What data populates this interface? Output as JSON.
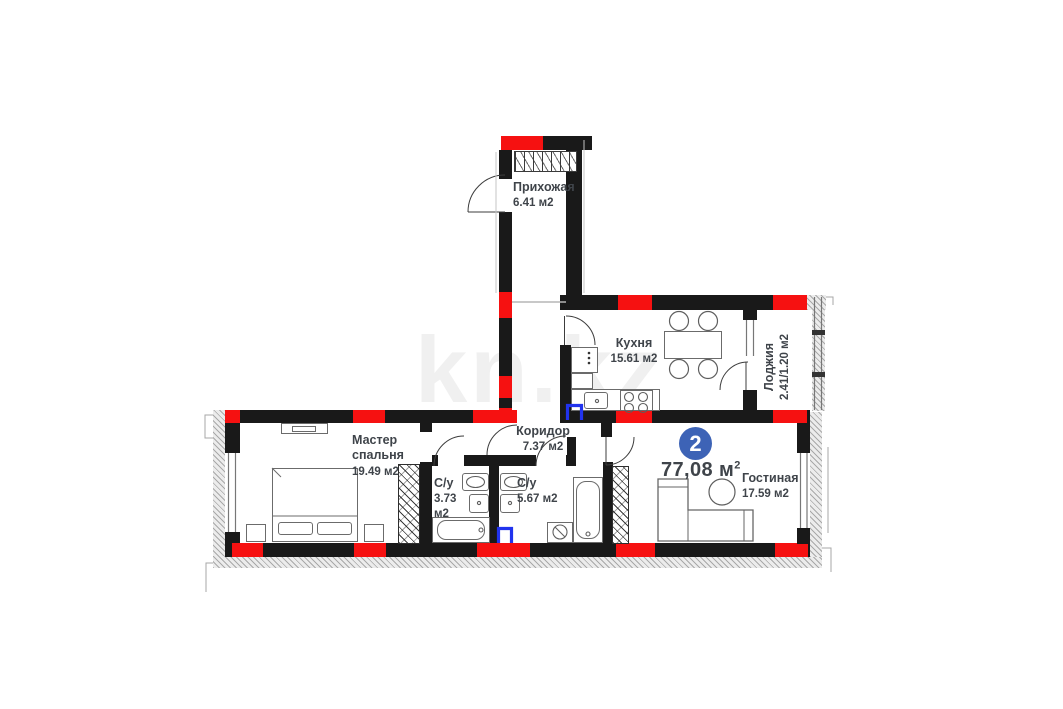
{
  "plan": {
    "watermark": "kn.kz",
    "badge": {
      "number": "2"
    },
    "total_area": {
      "main": "77,08 м",
      "sup": "2"
    },
    "rooms": [
      {
        "name": "Прихожая",
        "area": "6.41 м2"
      },
      {
        "name": "Кухня",
        "area": "15.61 м2"
      },
      {
        "name": "Лоджия",
        "area": "2.41/1.20 м2"
      },
      {
        "name": "Коридор",
        "area": "7.37 м2"
      },
      {
        "name": "Мастер спальня",
        "area": "19.49 м2"
      },
      {
        "name": "С/у",
        "area": "3.73 м2"
      },
      {
        "name": "С/у",
        "area": "5.67 м2"
      },
      {
        "name": "Гостиная",
        "area": "17.59 м2"
      }
    ],
    "colors": {
      "wall": "#191919",
      "marker_red": "#f61111",
      "plumbing_blue": "#2133ee",
      "badge_blue": "#3d63b6",
      "label_text": "#3f444a"
    }
  }
}
